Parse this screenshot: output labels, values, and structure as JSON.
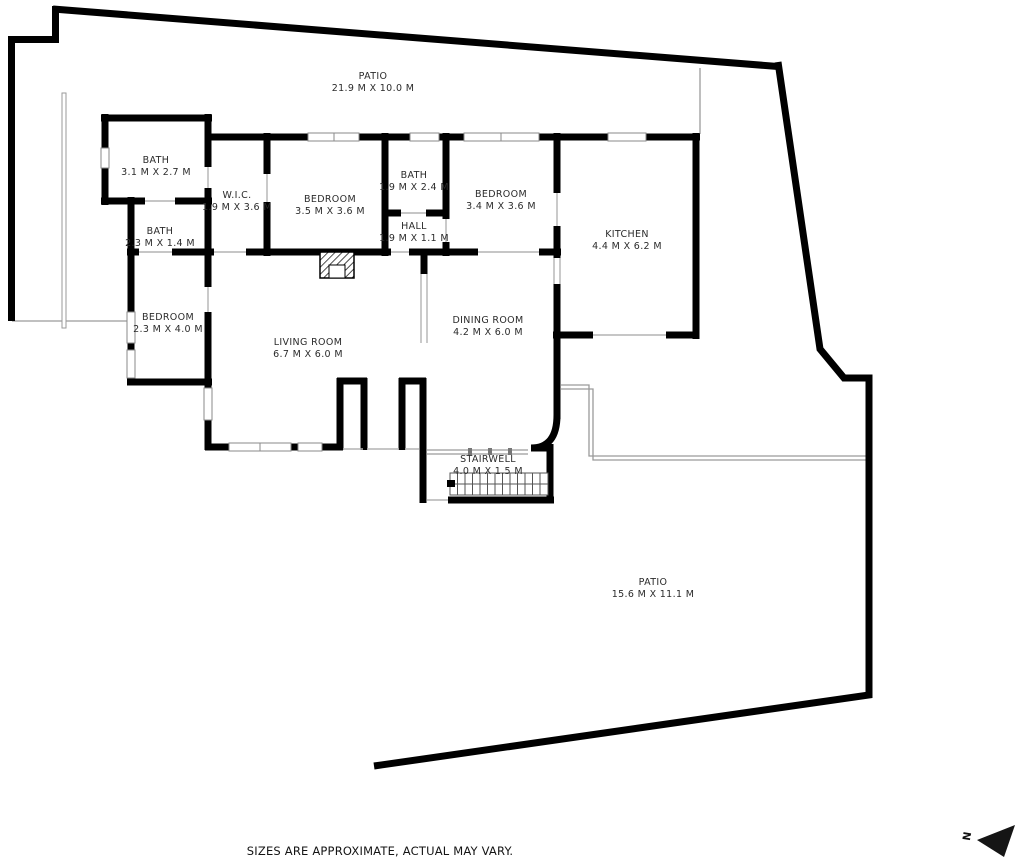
{
  "plan": {
    "footer": "SIZES ARE APPROXIMATE, ACTUAL MAY VARY.",
    "compass": {
      "label": "N"
    },
    "rooms": [
      {
        "name": "PATIO",
        "dims": "21.9 M X 10.0 M"
      },
      {
        "name": "BATH",
        "dims": "3.1 M X 2.7 M"
      },
      {
        "name": "BATH",
        "dims": "2.3 M X 1.4 M"
      },
      {
        "name": "W.I.C.",
        "dims": "1.9 M X 3.6 M"
      },
      {
        "name": "BEDROOM",
        "dims": "3.5 M X 3.6 M"
      },
      {
        "name": "BATH",
        "dims": "1.9 M X 2.4 M"
      },
      {
        "name": "HALL",
        "dims": "1.9 M X 1.1 M"
      },
      {
        "name": "BEDROOM",
        "dims": "3.4 M X 3.6 M"
      },
      {
        "name": "KITCHEN",
        "dims": "4.4 M X 6.2 M"
      },
      {
        "name": "BEDROOM",
        "dims": "2.3 M X 4.0 M"
      },
      {
        "name": "LIVING ROOM",
        "dims": "6.7 M X 6.0 M"
      },
      {
        "name": "DINING ROOM",
        "dims": "4.2 M X 6.0 M"
      },
      {
        "name": "STAIRWELL",
        "dims": "4.0 M X 1.5 M"
      },
      {
        "name": "PATIO",
        "dims": "15.6 M X 11.1 M"
      }
    ]
  }
}
